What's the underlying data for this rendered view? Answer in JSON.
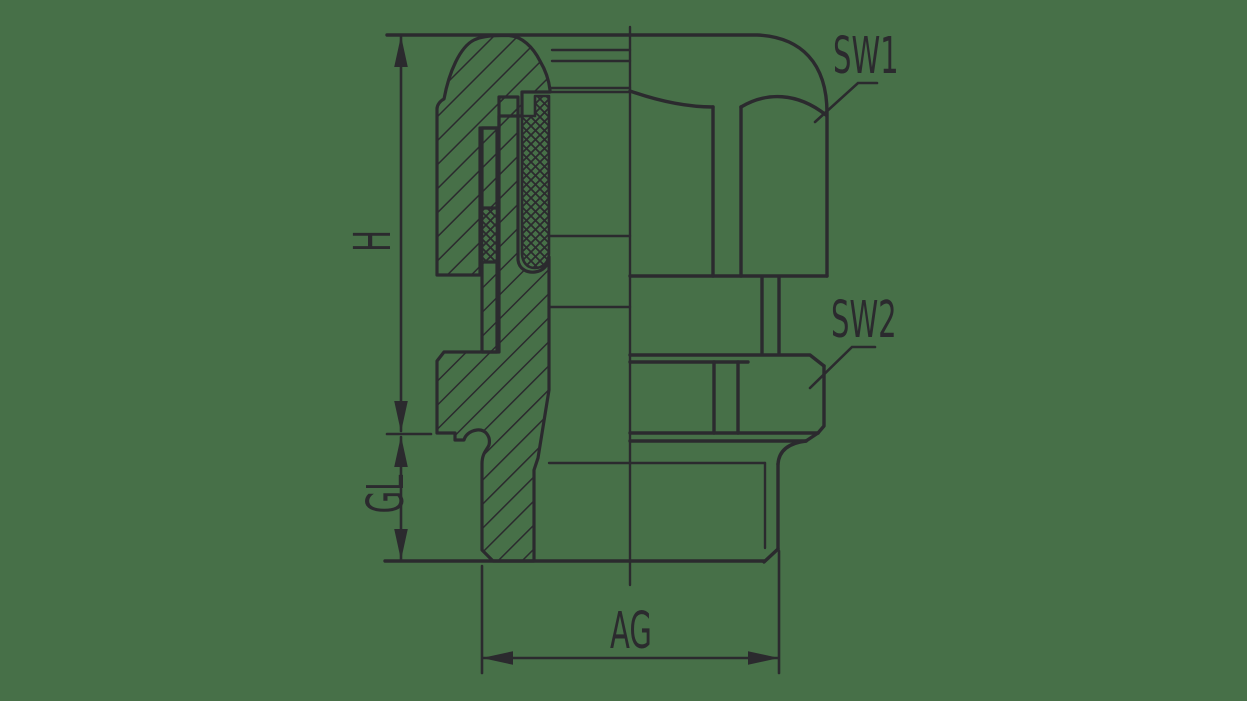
{
  "canvas": {
    "background": "#477048",
    "line_color": "#2b2a2e"
  },
  "drawing": {
    "type": "technical-section-drawing",
    "subject": "cable-gland",
    "left_view": "half section (hatched cut, crosshatched seal insert)",
    "right_view": "exterior elevation"
  },
  "dimensions": {
    "height_label": "H",
    "gland_thread_length_label": "GL",
    "connection_thread_label": "AG"
  },
  "callouts": {
    "wrench_size_1": "SW1",
    "wrench_size_2": "SW2"
  }
}
